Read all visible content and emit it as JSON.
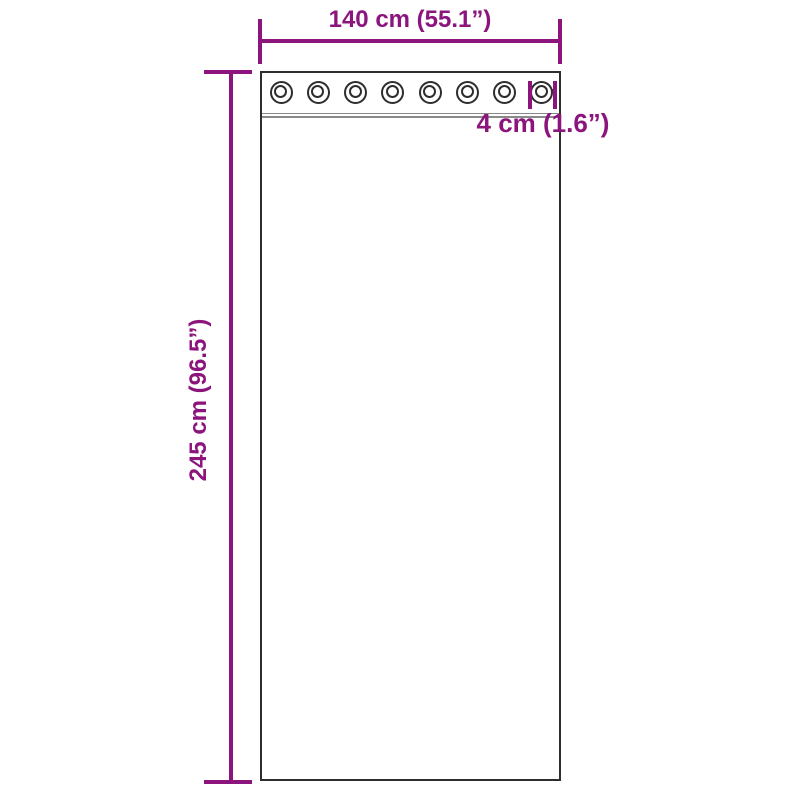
{
  "diagram": {
    "type": "product-dimension-diagram",
    "subject": "curtain-with-grommets",
    "width_dimension": {
      "label": "140 cm (55.1”)"
    },
    "height_dimension": {
      "label": "245 cm (96.5”)"
    },
    "grommet_dimension": {
      "label": "4 cm (1.6”)"
    },
    "grommet_count": 8,
    "colors": {
      "dimension": "#8B157D",
      "outline": "#2D2D2D",
      "seam": "#8A8A8A",
      "background": "#FFFFFF"
    }
  }
}
